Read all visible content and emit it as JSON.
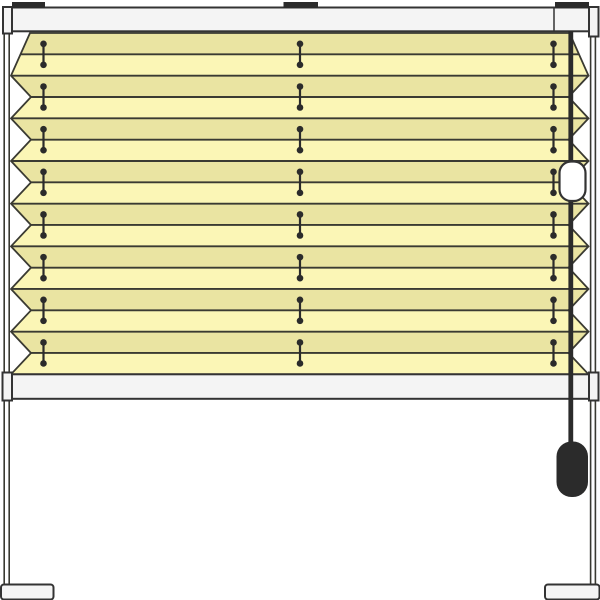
{
  "scene": {
    "description": "Technical illustration of a pleated blind (plissee) mounted on a freestanding frame with legs and feet",
    "background": "#ffffff"
  },
  "colors": {
    "background": "#ffffff",
    "outline": "#3a3a32",
    "hardware": "#2b2b2b",
    "rail_fill": "#f4f4f4",
    "rail_stroke": "#333333",
    "foot_fill": "#f5f5f5",
    "fabric_light": "#fbf6b6",
    "fabric_dark": "#eae4a2",
    "capsule_fill": "#ffffff"
  },
  "components": {
    "mounting_brackets": 3,
    "pleat_count": 8,
    "fabric_band_count": 16,
    "cord_stitch_columns": 3,
    "stitch_pairs_per_column": 8,
    "head_rail": "top rail",
    "bottom_rail": "bottom rail",
    "cord_lock": "white capsule on lift cord",
    "tassel": "dark pull tassel on lift cord",
    "stand": "two legs with floor feet"
  },
  "geometry": {
    "canvas": {
      "width": 600,
      "height": 600
    },
    "fabric": {
      "top": 33,
      "bottom": 374.3,
      "band_count": 16,
      "left_outer_x": 11,
      "left_inner_x": 31,
      "right_outer_x": 588.5,
      "right_inner_x": 568.5,
      "top_left_x": 30,
      "top_right_x": 569.5
    },
    "stitch": {
      "columns_x": [
        43.5,
        300,
        553.5
      ],
      "half_span": 10.5,
      "dot_radius": 3.3
    },
    "head_rail": {
      "x": 12,
      "y": 7.5,
      "w": 577,
      "h": 23.8,
      "seam_x": 554
    },
    "brackets": [
      {
        "x": 12,
        "y": 2,
        "w": 33,
        "h": 6
      },
      {
        "x": 283.5,
        "y": 2,
        "w": 34.5,
        "h": 6
      },
      {
        "x": 555,
        "y": 2,
        "w": 34,
        "h": 6
      }
    ],
    "bottom_rail": {
      "x": 12,
      "y": 374.3,
      "w": 577,
      "h": 24.5
    },
    "cord": {
      "x": 568.4,
      "top": 31,
      "bottom": 442,
      "w": 4.8
    },
    "capsule": {
      "x": 559.5,
      "y": 161.5,
      "w": 26,
      "h": 39.5,
      "rx": 11.5
    },
    "tassel": {
      "x": 556.5,
      "y": 441.5,
      "w": 31.5,
      "h": 55.5,
      "rx": 15
    }
  }
}
